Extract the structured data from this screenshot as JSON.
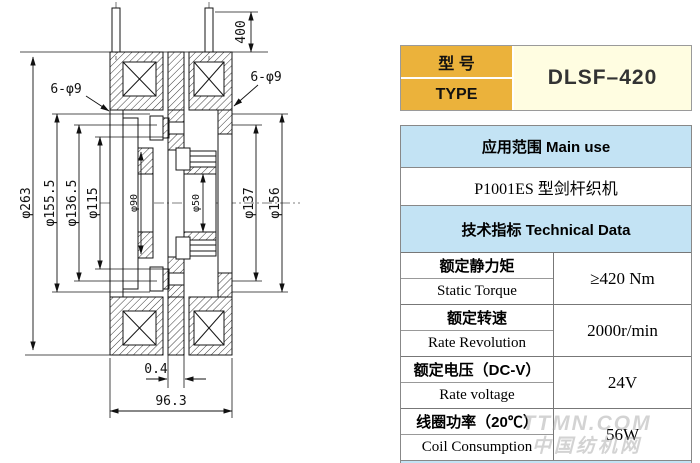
{
  "drawing": {
    "dims": {
      "d263": "φ263",
      "d155": "φ155.5",
      "d136": "φ136.5",
      "d115": "φ115",
      "d90": "φ90",
      "d50": "φ50",
      "d137": "φ137",
      "d156": "φ156",
      "holes_left": "6-φ9",
      "holes_right": "6-φ9",
      "lead_length": "400",
      "gap": "0.4",
      "width": "96.3"
    }
  },
  "type_table": {
    "label_cn": "型 号",
    "label_en": "TYPE",
    "value": "DLSF–420"
  },
  "main_table": {
    "use_header": "应用范围  Main use",
    "use_value": "P1001ES  型剑杆织机",
    "tech_header": "技术指标  Technical Data",
    "rows": [
      {
        "cn": "额定静力矩",
        "en": "Static Torque",
        "value": "≥420 Nm"
      },
      {
        "cn": "额定转速",
        "en": "Rate Revolution",
        "value": "2000r/min"
      },
      {
        "cn": "额定电压（DC-V）",
        "en": "Rate voltage",
        "value": "24V"
      },
      {
        "cn": "线圈功率（20℃）",
        "en": "Coil Consumption",
        "value": "56W"
      }
    ]
  },
  "watermark": {
    "line1": "TTMN.COM",
    "line2": "中国纺机网"
  },
  "colors": {
    "orange": "#ebb23b",
    "cream": "#fffde1",
    "blue": "#c3e3f4"
  }
}
